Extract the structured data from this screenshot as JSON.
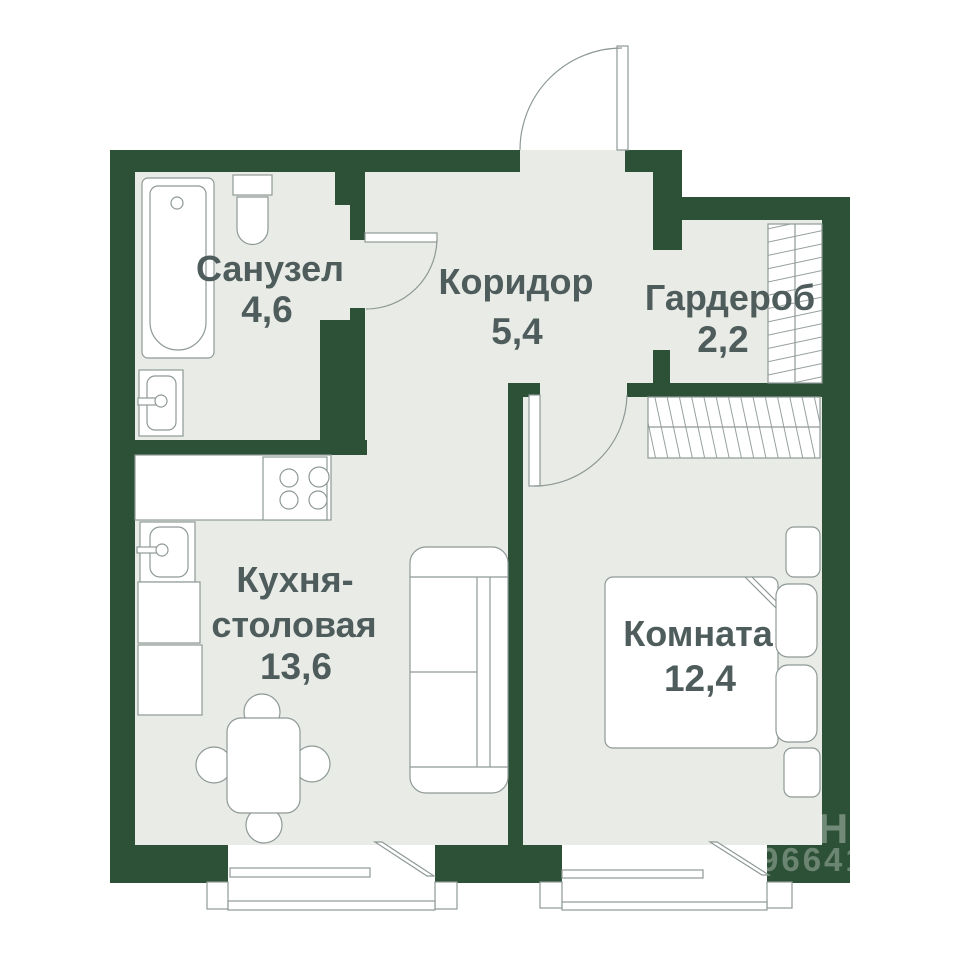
{
  "colors": {
    "wall": "#2d5136",
    "floor": "#e9ebe7",
    "line": "#8e9996",
    "label": "#4e5c5c",
    "background": "#ffffff"
  },
  "rooms": [
    {
      "id": "bathroom",
      "name": "Санузел",
      "area": "4,6"
    },
    {
      "id": "corridor",
      "name": "Коридор",
      "area": "5,4"
    },
    {
      "id": "wardrobe",
      "name": "Гардероб",
      "area": "2,2"
    },
    {
      "id": "kitchen",
      "name": "Кухня-",
      "name_line2": "столовая",
      "area": "13,6"
    },
    {
      "id": "room",
      "name": "Комната",
      "area": "12,4"
    }
  ],
  "watermark": {
    "letters": "Н",
    "digits": "966414"
  }
}
